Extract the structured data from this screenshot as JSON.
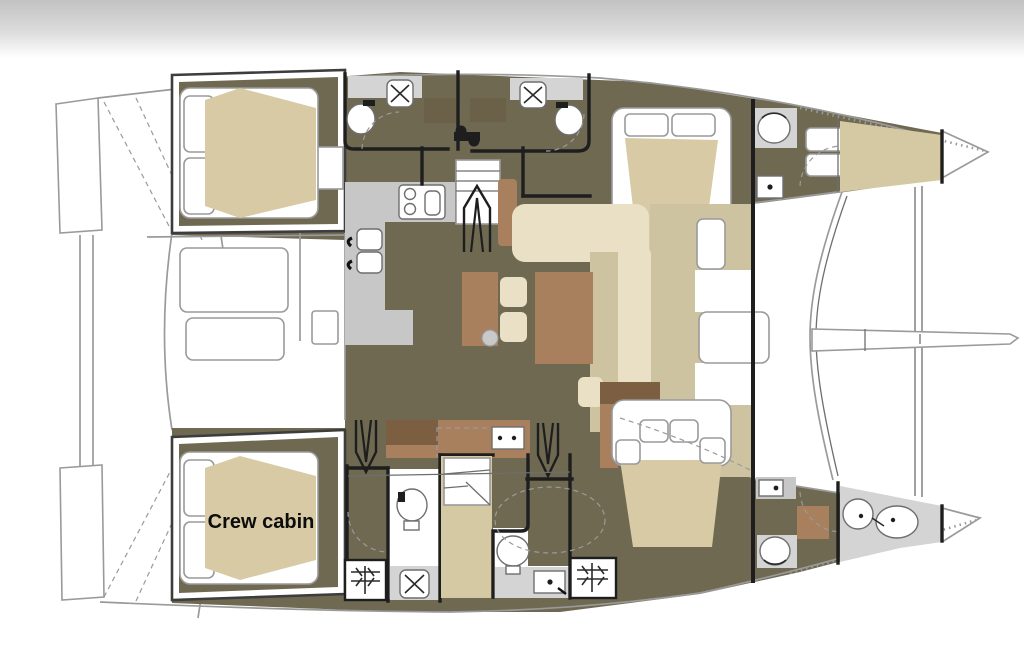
{
  "page": {
    "description": "catamaran-interior-floor-plan",
    "orientation": "bow-right"
  },
  "colors": {
    "band_gray": "#c2c2c2",
    "floor_olive": "#6f6952",
    "mattress_tan": "#d7caa4",
    "forepeak_tan": "#d5c9a3",
    "deck_khaki": "#cdc3a1",
    "sofa_cream": "#e9e0c6",
    "furniture_brown": "#a8805d",
    "furniture_dark_brown": "#7c5f41",
    "locker_brown": "#6b6148",
    "counter_gray": "#c7c7c7",
    "floor_gray": "#d4d4d4",
    "wall_black": "#1e1e1e",
    "outline_gray": "#9a9a9a",
    "outline_dark": "#6e6e6e"
  },
  "labels": {
    "crew_cabin": "Crew cabin"
  },
  "rooms": [
    "cockpit",
    "salon",
    "galley",
    "dinette",
    "companionway",
    "port-aft-cabin",
    "port-head-aft",
    "port-head-mid",
    "port-forward-cabin",
    "port-forward-head",
    "port-forepeak",
    "crew-cabin",
    "starboard-head-aft",
    "wardrobe",
    "starboard-head-mid",
    "starboard-forward-cabin",
    "starboard-forward-head",
    "starboard-forepeak",
    "foredeck",
    "transom-steps"
  ],
  "fixtures": [
    "double-bed",
    "pillows",
    "shower",
    "toilet",
    "washbasin",
    "stove",
    "galley-sink",
    "dinette-table",
    "stools",
    "sofa",
    "nav-seats",
    "stairs-up-arrow",
    "stairs-down-arrow",
    "mast-step",
    "vent-grate",
    "foredeck-door",
    "trampoline-beam",
    "bowsprit",
    "cockpit-benches"
  ]
}
